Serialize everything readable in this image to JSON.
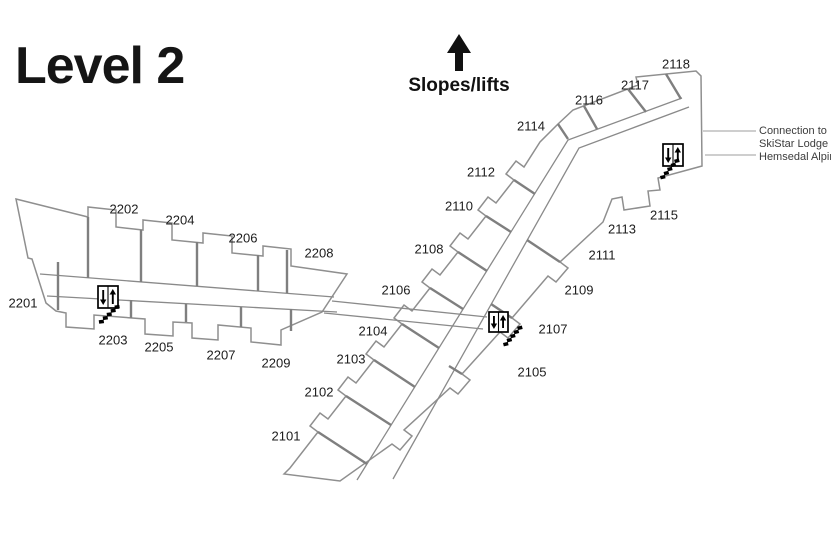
{
  "page_title": "Level 2",
  "slopes_label": "Slopes/lifts",
  "connection_note": {
    "line1": "Connection to",
    "line2": "SkiStar Lodge",
    "line3": "Hemsedal Alpin"
  },
  "colors": {
    "background": "#ffffff",
    "wall": "#8f8f8f",
    "unit_divider": "#7f7f7f",
    "label_text": "#1c1c1c",
    "title_text": "#151515",
    "icon": "#000000"
  },
  "map": {
    "rooms": [
      {
        "id": "2101",
        "x": 286,
        "y": 436
      },
      {
        "id": "2102",
        "x": 319,
        "y": 392
      },
      {
        "id": "2103",
        "x": 351,
        "y": 359
      },
      {
        "id": "2104",
        "x": 373,
        "y": 331
      },
      {
        "id": "2105",
        "x": 532,
        "y": 372
      },
      {
        "id": "2106",
        "x": 396,
        "y": 290
      },
      {
        "id": "2107",
        "x": 553,
        "y": 329
      },
      {
        "id": "2108",
        "x": 429,
        "y": 249
      },
      {
        "id": "2109",
        "x": 579,
        "y": 290
      },
      {
        "id": "2110",
        "x": 459,
        "y": 206
      },
      {
        "id": "2111",
        "x": 602,
        "y": 255
      },
      {
        "id": "2112",
        "x": 481,
        "y": 172
      },
      {
        "id": "2113",
        "x": 622,
        "y": 229
      },
      {
        "id": "2114",
        "x": 531,
        "y": 126
      },
      {
        "id": "2115",
        "x": 664,
        "y": 215
      },
      {
        "id": "2116",
        "x": 589,
        "y": 100
      },
      {
        "id": "2117",
        "x": 635,
        "y": 85
      },
      {
        "id": "2118",
        "x": 676,
        "y": 64
      },
      {
        "id": "2201",
        "x": 23,
        "y": 303
      },
      {
        "id": "2202",
        "x": 124,
        "y": 209
      },
      {
        "id": "2203",
        "x": 113,
        "y": 340
      },
      {
        "id": "2204",
        "x": 180,
        "y": 220
      },
      {
        "id": "2205",
        "x": 159,
        "y": 347
      },
      {
        "id": "2206",
        "x": 243,
        "y": 238
      },
      {
        "id": "2207",
        "x": 221,
        "y": 355
      },
      {
        "id": "2208",
        "x": 319,
        "y": 253
      },
      {
        "id": "2209",
        "x": 276,
        "y": 363
      }
    ],
    "elevators": [
      {
        "x": 98,
        "y": 286,
        "w": 20,
        "h": 22
      },
      {
        "x": 489,
        "y": 312,
        "w": 19,
        "h": 20
      },
      {
        "x": 663,
        "y": 144,
        "w": 20,
        "h": 22
      }
    ],
    "stairs": [
      {
        "x": 97,
        "y": 308,
        "rot": -8
      },
      {
        "x": 500,
        "y": 331,
        "rot": -14
      },
      {
        "x": 657,
        "y": 164,
        "rot": -14
      }
    ]
  }
}
